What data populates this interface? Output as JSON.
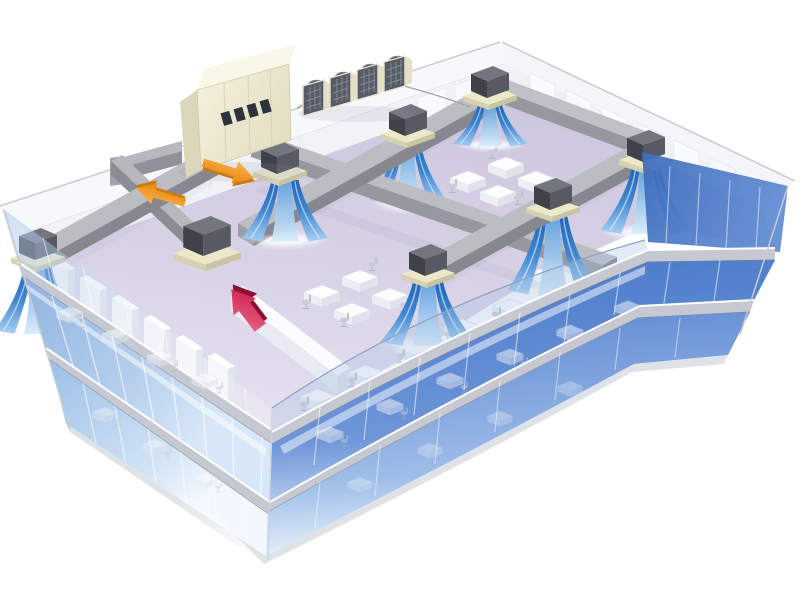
{
  "scene": {
    "kind": "isometric-cutaway-illustration",
    "subject": "Central ducted air-conditioning system serving an open-plan office top floor of a 3-storey glass office building",
    "building": {
      "floors_visible": 3,
      "top_floor": "cutaway open-plan office with ceiling duct network",
      "lower_floors": "seen through tinted glass curtain wall with desks and chairs"
    },
    "rooftop": {
      "air_handling_unit": {
        "label": "air handling unit",
        "vent_count": 4
      },
      "condenser_bank": {
        "label": "outdoor condenser units",
        "unit_count": 4,
        "fans_per_unit": 1
      },
      "refrigerant_pipe": {
        "label": "rooftop piping"
      }
    },
    "duct_system": {
      "supply_trunks": 2,
      "supply_branches": 3,
      "return_segments": 2,
      "ceiling_supply_outlets": 7,
      "return_air_intakes": 1
    },
    "airflow": {
      "supply_streams": {
        "count": 7,
        "description": "blue conditioned-air curtains blowing down into office"
      },
      "arrows": [
        {
          "name": "supply-air-arrow",
          "direction": "right-down along supply duct",
          "color": "#ef941c"
        },
        {
          "name": "return-air-arrow",
          "direction": "left-up toward air handling unit",
          "color": "#ef941c"
        },
        {
          "name": "room-return-arrow",
          "direction": "up into return-air intake",
          "color": "#d92a52"
        }
      ]
    },
    "furniture": {
      "desk_clusters_top_floor": 4,
      "desks_along_window": 5,
      "partition_piers": 6,
      "back_wall_cabinets": 8
    },
    "colors": {
      "background": "#ffffff",
      "floor": "#d9d3e7",
      "roof_band": "#f7f8fa",
      "back_wall": "#f2f3f7",
      "duct_top": "#bcbdc3",
      "duct_side": "#96979f",
      "duct_side_dark": "#86878f",
      "unit_dark": "#4b4d57",
      "unit_base": "#ece8ca",
      "ahu_body": "#f0edd8",
      "ahu_side": "#dcd7ba",
      "ahu_vent": "#2e323d",
      "condenser_grille": "#565b66",
      "stream_deep": "#1d63b8",
      "stream_light": "#bcdcf6",
      "glass_left": "#9dbbe2",
      "glass_right": "#4979ca",
      "slab_band": "#c6c9d1",
      "arrow_orange": "#ef941c",
      "arrow_red": "#d92a52",
      "desk_white": "#fdfdff",
      "chair_gray": "#bdc1cb"
    }
  }
}
